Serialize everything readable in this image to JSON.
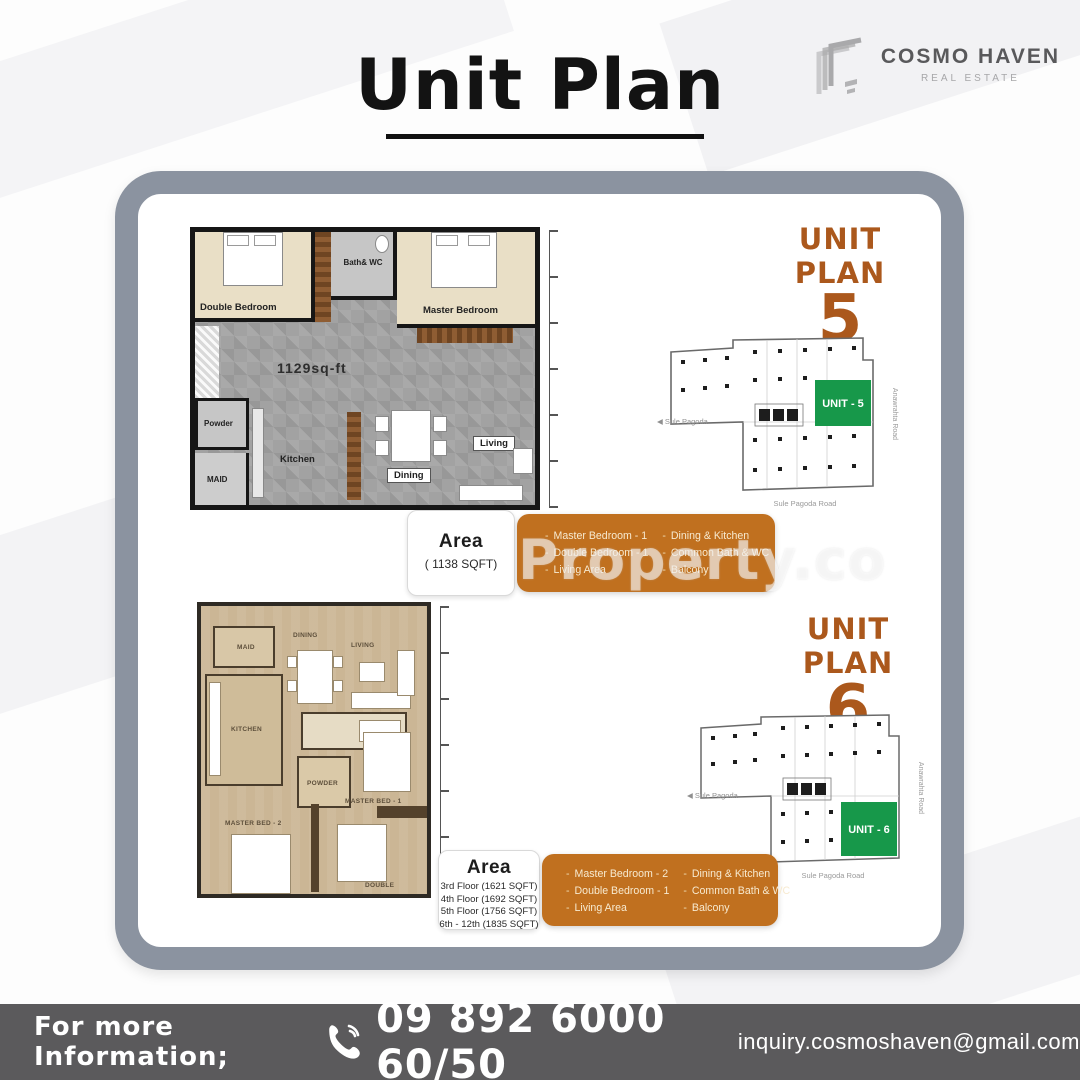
{
  "page": {
    "title": "Unit Plan"
  },
  "brand": {
    "name": "COSMO HAVEN",
    "tagline": "REAL ESTATE"
  },
  "watermark": "Property.co",
  "unit5": {
    "title": "UNIT PLAN",
    "number": "5",
    "plan": {
      "area_label": "1129sq-ft",
      "rooms": {
        "double_bedroom": "Double Bedroom",
        "bath_wc": "Bath& WC",
        "master_bedroom": "Master Bedroom",
        "powder": "Powder",
        "maid": "MAID",
        "kitchen": "Kitchen",
        "dining": "Dining",
        "living": "Living"
      }
    },
    "site": {
      "unit": "UNIT - 5",
      "left": "◀ Sule Pagoda",
      "right": "Anawrahta Road",
      "bottom": "Sule Pagoda Road"
    },
    "area_title": "Area",
    "area_value": "( 1138 SQFT)",
    "features": {
      "col1": [
        "Master Bedroom - 1",
        "Double Bedroom - 1",
        "Living Area"
      ],
      "col2": [
        "Dining & Kitchen",
        "Common Bath & WC",
        "Balcony"
      ]
    }
  },
  "unit6": {
    "title": "UNIT PLAN",
    "number": "6",
    "plan": {
      "rooms": {
        "living": "LIVING",
        "dining": "DINING",
        "maid": "MAID",
        "kitchen": "KITCHEN",
        "powder": "POWDER",
        "master1": "MASTER BED - 1",
        "master2": "MASTER BED - 2",
        "double": "DOUBLE"
      }
    },
    "site": {
      "unit": "UNIT - 6",
      "left": "◀ Sule Pagoda",
      "right": "Anawrahta Road",
      "bottom": "Sule Pagoda Road"
    },
    "area_title": "Area",
    "floors": [
      "3rd Floor (1621 SQFT)",
      "4th Floor (1692 SQFT)",
      "5th Floor (1756 SQFT)",
      "6th - 12th (1835 SQFT)"
    ],
    "features": {
      "col1": [
        "Master Bedroom - 2",
        "Double Bedroom - 1",
        "Living Area"
      ],
      "col2": [
        "Dining & Kitchen",
        "Common Bath & WC",
        "Balcony"
      ]
    }
  },
  "footer": {
    "label": "For more Information;",
    "phone": "09 892 6000 60/50",
    "email": "inquiry.cosmoshaven@gmail.com"
  },
  "colors": {
    "accent_orange": "#c0701f",
    "title_orange": "#ab581c",
    "unit_green": "#17984a",
    "card_border": "#8b93a0",
    "footer_bg": "#5b5a5c"
  }
}
